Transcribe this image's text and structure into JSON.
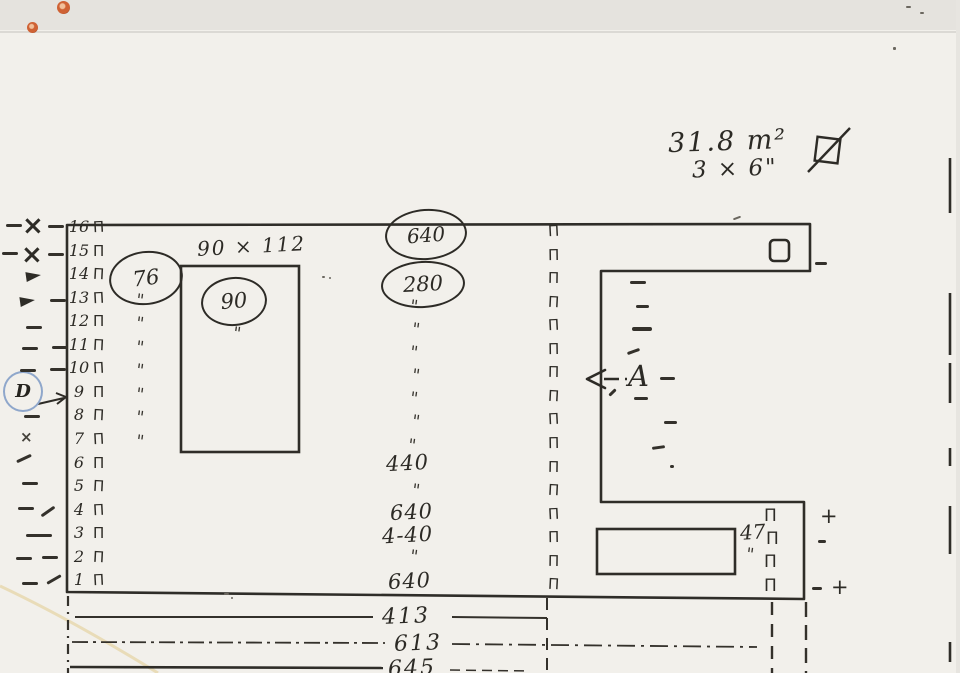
{
  "notes": {
    "area": "31.8 m²",
    "size": "3 × 6\""
  },
  "labels": {
    "dimension": "90 × 112",
    "section": "A",
    "blue_mark": "D"
  },
  "circles": {
    "left": "76",
    "inner": "90",
    "top": "640",
    "mid": "280"
  },
  "left_scale": {
    "rows": [
      "16",
      "15",
      "14",
      "13",
      "12",
      "11",
      "10",
      "9",
      "8",
      "7",
      "6",
      "5",
      "4",
      "3",
      "2",
      "1"
    ],
    "pillar_glyph": "П",
    "ditto_glyph": "\"",
    "ditto_rows": [
      3,
      4,
      5,
      6,
      7,
      8,
      9
    ]
  },
  "mid_column": [
    {
      "t": "\"",
      "x": 410,
      "y": 299
    },
    {
      "t": "\"",
      "x": 412,
      "y": 322
    },
    {
      "t": "\"",
      "x": 410,
      "y": 345
    },
    {
      "t": "\"",
      "x": 412,
      "y": 368
    },
    {
      "t": "\"",
      "x": 410,
      "y": 391
    },
    {
      "t": "\"",
      "x": 412,
      "y": 414
    },
    {
      "t": "\"",
      "x": 408,
      "y": 438
    },
    {
      "t": "440",
      "x": 386,
      "y": 453,
      "big": 1
    },
    {
      "t": "\"",
      "x": 412,
      "y": 483
    },
    {
      "t": "640",
      "x": 390,
      "y": 502,
      "big": 1
    },
    {
      "t": "4-40",
      "x": 382,
      "y": 525,
      "big": 1
    },
    {
      "t": "\"",
      "x": 410,
      "y": 549
    },
    {
      "t": "640",
      "x": 388,
      "y": 571,
      "big": 1
    }
  ],
  "extra_dittos": [
    {
      "x": 233,
      "y": 326
    }
  ],
  "bottom_labels": [
    {
      "t": "413",
      "x": 382,
      "y": 606
    },
    {
      "t": "613",
      "x": 394,
      "y": 633
    },
    {
      "t": "645",
      "x": 388,
      "y": 658
    }
  ],
  "right_block": {
    "value": "47",
    "ditto": "\"",
    "pillar_glyph": "П",
    "pillars": [
      {
        "x": 764,
        "y": 508
      },
      {
        "x": 766,
        "y": 531
      },
      {
        "x": 764,
        "y": 554
      },
      {
        "x": 764,
        "y": 578
      }
    ]
  },
  "margin_marks": [
    {
      "g": "d",
      "x": 6,
      "y": 224
    },
    {
      "g": "x",
      "x": 22,
      "y": 213
    },
    {
      "g": "d",
      "x": 48,
      "y": 225
    },
    {
      "g": "d",
      "x": 2,
      "y": 252
    },
    {
      "g": "x",
      "x": 21,
      "y": 242
    },
    {
      "g": "d",
      "x": 48,
      "y": 253
    },
    {
      "g": "t",
      "x": 26,
      "y": 271
    },
    {
      "g": "t",
      "x": 20,
      "y": 296
    },
    {
      "g": "d",
      "x": 50,
      "y": 299
    },
    {
      "g": "d",
      "x": 26,
      "y": 326
    },
    {
      "g": "d",
      "x": 22,
      "y": 347
    },
    {
      "g": "d",
      "x": 52,
      "y": 346
    },
    {
      "g": "d",
      "x": 20,
      "y": 369
    },
    {
      "g": "d",
      "x": 50,
      "y": 368
    },
    {
      "g": "d",
      "x": 24,
      "y": 415
    },
    {
      "g": "xs",
      "x": 20,
      "y": 430
    },
    {
      "g": "d",
      "x": 16,
      "y": 457,
      "rot": -25
    },
    {
      "g": "d",
      "x": 22,
      "y": 482
    },
    {
      "g": "d",
      "x": 18,
      "y": 507
    },
    {
      "g": "d",
      "x": 40,
      "y": 510,
      "rot": -35
    },
    {
      "g": "d",
      "x": 26,
      "y": 534,
      "w": 26
    },
    {
      "g": "d",
      "x": 16,
      "y": 557
    },
    {
      "g": "d",
      "x": 42,
      "y": 556
    },
    {
      "g": "d",
      "x": 22,
      "y": 582
    },
    {
      "g": "d",
      "x": 46,
      "y": 578,
      "rot": -30
    }
  ],
  "notch_dashes": [
    {
      "x": 630,
      "y": 281,
      "w": 16
    },
    {
      "x": 636,
      "y": 305,
      "w": 13
    },
    {
      "x": 632,
      "y": 327,
      "w": 20,
      "h": 4
    },
    {
      "x": 627,
      "y": 350,
      "w": 13,
      "rot": -20
    },
    {
      "x": 660,
      "y": 377,
      "w": 15
    },
    {
      "x": 608,
      "y": 391,
      "w": 9,
      "rot": -45
    },
    {
      "x": 634,
      "y": 397,
      "w": 14
    },
    {
      "x": 664,
      "y": 421,
      "w": 13
    },
    {
      "x": 652,
      "y": 446,
      "w": 13,
      "rot": -8
    },
    {
      "x": 670,
      "y": 465,
      "w": 4,
      "h": 3
    }
  ],
  "right_marks": [
    {
      "x": 815,
      "y": 262,
      "w": 12
    },
    {
      "x": 818,
      "y": 540,
      "w": 8
    },
    {
      "x": 812,
      "y": 587,
      "w": 10
    }
  ],
  "plus_marks": [
    {
      "x": 820,
      "y": 506
    },
    {
      "x": 831,
      "y": 577
    }
  ],
  "specks": [
    {
      "x": 224,
      "y": 593,
      "w": 5,
      "h": 2
    },
    {
      "x": 231,
      "y": 597,
      "w": 2,
      "h": 2
    },
    {
      "x": 322,
      "y": 276,
      "w": 3,
      "h": 2
    },
    {
      "x": 329,
      "y": 277,
      "w": 2,
      "h": 2
    },
    {
      "x": 733,
      "y": 217,
      "w": 8,
      "h": 2,
      "rot": -20
    },
    {
      "x": 906,
      "y": 6,
      "w": 5,
      "h": 2
    },
    {
      "x": 920,
      "y": 12,
      "w": 4,
      "h": 2
    },
    {
      "x": 893,
      "y": 47,
      "w": 3,
      "h": 3
    }
  ]
}
